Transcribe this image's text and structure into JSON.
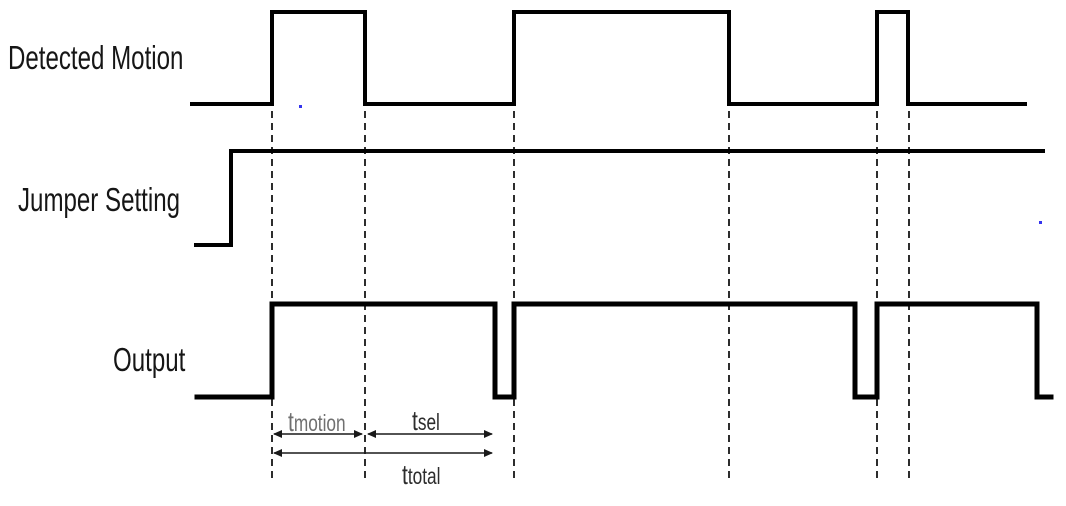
{
  "signals": [
    {
      "label": "Detected Motion"
    },
    {
      "label": "Jumper Setting"
    },
    {
      "label": "Output"
    }
  ],
  "timing": {
    "motion": {
      "base": "t",
      "sub": "motion"
    },
    "sel": {
      "base": "t",
      "sub": "sel"
    },
    "total": {
      "base": "t",
      "sub": "total"
    }
  },
  "waveforms": {
    "color": "#000000",
    "signals": [
      {
        "name": "detected-motion",
        "stroke": 4,
        "points": [
          [
            192,
            104
          ],
          [
            272,
            104
          ],
          [
            272,
            12
          ],
          [
            365,
            12
          ],
          [
            365,
            104
          ],
          [
            514,
            104
          ],
          [
            514,
            12
          ],
          [
            729,
            12
          ],
          [
            729,
            104
          ],
          [
            877,
            104
          ],
          [
            877,
            12
          ],
          [
            908,
            12
          ],
          [
            908,
            104
          ],
          [
            1025,
            104
          ]
        ]
      },
      {
        "name": "jumper-setting",
        "stroke": 4,
        "points": [
          [
            196,
            245
          ],
          [
            231,
            245
          ],
          [
            231,
            151
          ],
          [
            1043,
            151
          ]
        ]
      },
      {
        "name": "output",
        "stroke": 5,
        "points": [
          [
            197,
            397
          ],
          [
            272,
            397
          ],
          [
            272,
            304
          ],
          [
            495,
            304
          ],
          [
            495,
            397
          ],
          [
            514,
            397
          ],
          [
            514,
            304
          ],
          [
            855,
            304
          ],
          [
            855,
            397
          ],
          [
            877,
            397
          ],
          [
            877,
            304
          ],
          [
            1037,
            304
          ],
          [
            1037,
            397
          ],
          [
            1037,
            397
          ],
          [
            1051,
            397
          ]
        ]
      }
    ],
    "guides": {
      "x": [
        272,
        365,
        514,
        729,
        877,
        909
      ],
      "y1": 111,
      "y2": 481,
      "dash": "7 5",
      "stroke": 1.8,
      "color": "#161616"
    },
    "arrows": {
      "color": "#1a1a1a",
      "stroke": 1.4,
      "spans": [
        {
          "name": "t-motion-span",
          "x1": 274,
          "x2": 362,
          "y": 434
        },
        {
          "name": "t-sel-span",
          "x1": 368,
          "x2": 492,
          "y": 434
        },
        {
          "name": "t-total-span",
          "x1": 274,
          "x2": 492,
          "y": 453
        }
      ]
    },
    "dots": {
      "color": "#3434ee",
      "size": 3,
      "points": [
        [
          299,
          105
        ],
        [
          1039,
          221
        ]
      ]
    }
  }
}
